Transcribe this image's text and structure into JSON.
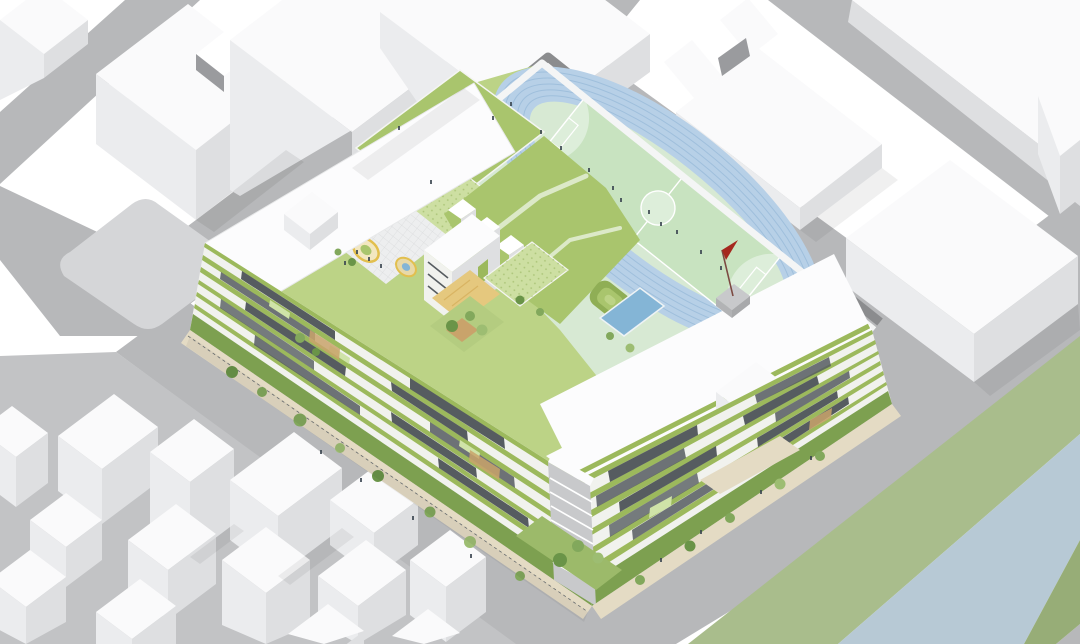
{
  "meta": {
    "title": "Isometric school campus architectural rendering",
    "description": "Axonometric rendering of a perimeter-block school with rooftop running track, green roofs, courtyards, surrounded by white context buildings, streets and a canal"
  },
  "palette": {
    "bg": "#ffffff",
    "road": "#b7b8ba",
    "roadLight": "#c6c7c9",
    "pad": "#d5d6d8",
    "clusterGround": "#c2c3c5",
    "bldgTop": "#fafafb",
    "faceLight": "#ebecee",
    "faceMid": "#dedfe1",
    "faceDark": "#cfd0d3",
    "notchShadow": "#9a9b9e",
    "river": "#b7c9d5",
    "bankGreen": "#a9bd8c",
    "bankGreenDark": "#97ad77",
    "trackBlue": "#b7d0e7",
    "trackLane": "#9fbfdc",
    "infield": "#d7e9d3",
    "pitchGreen": "#c8e3c0",
    "pitchLight": "#ddeeda",
    "lineWhite": "#ffffff",
    "wallDark": "#8b8c8e",
    "parapetWhite": "#f4f5f5",
    "roofGreen": "#a9c56d",
    "roofGreenDark": "#8fae55",
    "roofGreenLight": "#bcd386",
    "dotRoof": "#cddfa2",
    "facadeBand": "#9cb95c",
    "facadeWindow": "#565c60",
    "facadeLight": "#f1f2ee",
    "accentGlass": "#cfe3a8",
    "tan": "#c9a36b",
    "sandCourt": "#e5c87e",
    "plaza": "#edeeef",
    "playYellow": "#e2bf4e",
    "pond": "#84b5d6",
    "tree": "#82a85c",
    "treeDark": "#6a9448",
    "treeLight": "#9dbd72",
    "sidewalk": "#e4dbc4",
    "hedge": "#7da050",
    "people": "#3a4550",
    "flagRed": "#a5281e",
    "core": "#c8c9cb",
    "slabWhite": "#fcfcfd"
  },
  "scene": {
    "running_track": {
      "lanes": 6,
      "surface_color_name": "light-blue",
      "infield": "soccer-field"
    },
    "soccer_field": {
      "markings": [
        "boundary",
        "half-line",
        "center-circle",
        "penalty-arcs",
        "goal-boxes"
      ]
    },
    "flag": {
      "color_name": "red",
      "mount": "gray-platform"
    },
    "rooftop_canopies": 3,
    "terraced_mounds": 2,
    "courtyard_play_rings": 2,
    "facade_planter_bands_per_elevation": 6,
    "context_building_clusters": [
      "top-left",
      "top-center",
      "top-right",
      "bottom-left"
    ],
    "waterway": "canal-bottom-right"
  }
}
